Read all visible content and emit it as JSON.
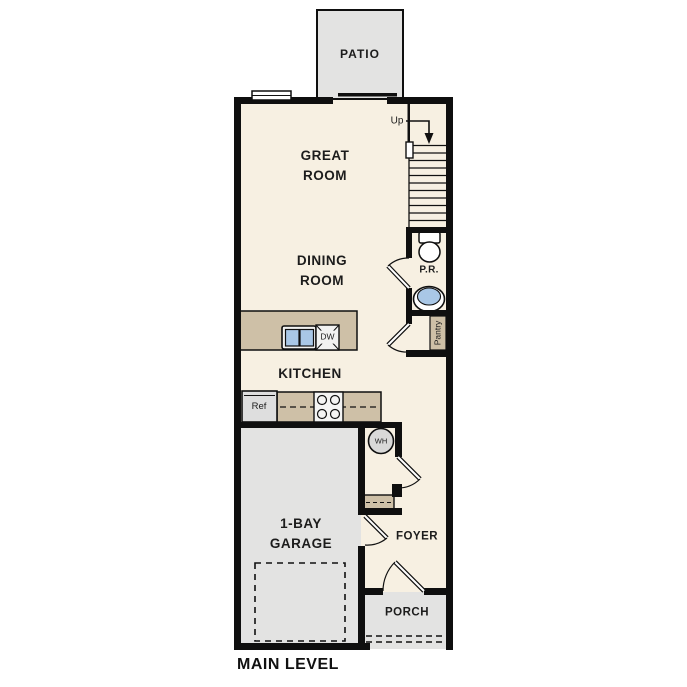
{
  "title": "MAIN LEVEL",
  "labels": {
    "patio": "PATIO",
    "great_room": {
      "line1": "GREAT",
      "line2": "ROOM"
    },
    "dining_room": {
      "line1": "DINING",
      "line2": "ROOM"
    },
    "kitchen": "KITCHEN",
    "garage": {
      "line1": "1-BAY",
      "line2": "GARAGE"
    },
    "foyer": "FOYER",
    "porch": "PORCH",
    "powder_room": "P.R.",
    "pantry": "Pantry",
    "stairs_up": "Up",
    "water_heater": "WH",
    "dishwasher": "DW",
    "refrigerator": "Ref"
  },
  "palette": {
    "floor_cream": "#f7f0e2",
    "outdoor_gray": "#e3e3e2",
    "counter_tan": "#cec0a7",
    "sink_blue": "#a9c7e6",
    "wall_black": "#0f0f0f",
    "fixture_gray": "#d9d9d8"
  }
}
